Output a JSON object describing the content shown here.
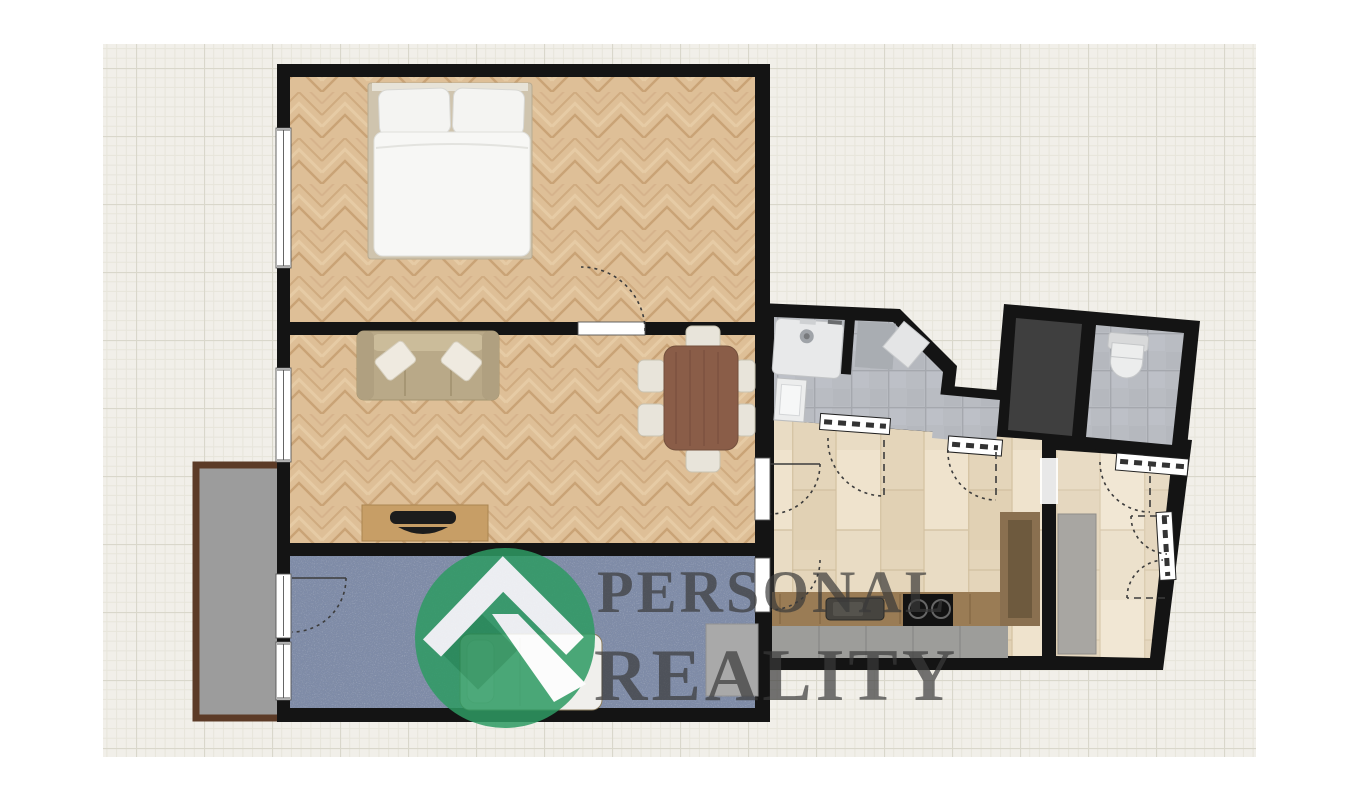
{
  "watermark": {
    "line1": "PERSONAL",
    "line2": "REALITY",
    "text_color": "#3a3a3a",
    "logo": {
      "name": "personal-reality-logo",
      "description": "green circle with white mountain chevron and arrow",
      "green": "#2e9b63",
      "dark_green": "#1f8a52",
      "white": "#ffffff"
    }
  },
  "colors": {
    "wall": "#141414",
    "grid_paper": "#f1efe9",
    "parquet_herringbone": "#debf97",
    "plank_floor": "#e9dcc4",
    "blue_carpet": "#7e8ba8",
    "gray_tile": "#b9bcc2",
    "dark_room_floor": "#3f3f3f",
    "balcony_floor": "#9c9c9c",
    "balcony_rail": "#5c3b27",
    "dining_table": "#8a5d48",
    "sofa": "#b9a988",
    "kitchen_counter": "#9a7c55",
    "wardrobe_gray": "#a8a6a2"
  },
  "floorplan": {
    "rooms": [
      {
        "id": "bedroom",
        "floor": "herringbone-parquet",
        "furniture": [
          "double-bed"
        ]
      },
      {
        "id": "living-room",
        "floor": "herringbone-parquet",
        "furniture": [
          "sofa",
          "tv-stand",
          "dining-table",
          "chairs"
        ]
      },
      {
        "id": "carpet-room",
        "floor": "blue-carpet",
        "furniture": [
          "single-bed",
          "wardrobe"
        ]
      },
      {
        "id": "balcony",
        "floor": "concrete"
      },
      {
        "id": "bathroom",
        "floor": "gray-tile",
        "furniture": [
          "bathtub",
          "sink",
          "shower"
        ]
      },
      {
        "id": "storage",
        "floor": "dark"
      },
      {
        "id": "wc",
        "floor": "gray-tile",
        "furniture": [
          "toilet"
        ]
      },
      {
        "id": "kitchen-hall",
        "floor": "wood-plank",
        "furniture": [
          "kitchen-counter",
          "kitchen-sink",
          "cooktop",
          "tall-cabinet"
        ]
      },
      {
        "id": "hallway",
        "floor": "wood-plank",
        "furniture": [
          "wardrobe",
          "entrance-double-door"
        ]
      }
    ]
  }
}
